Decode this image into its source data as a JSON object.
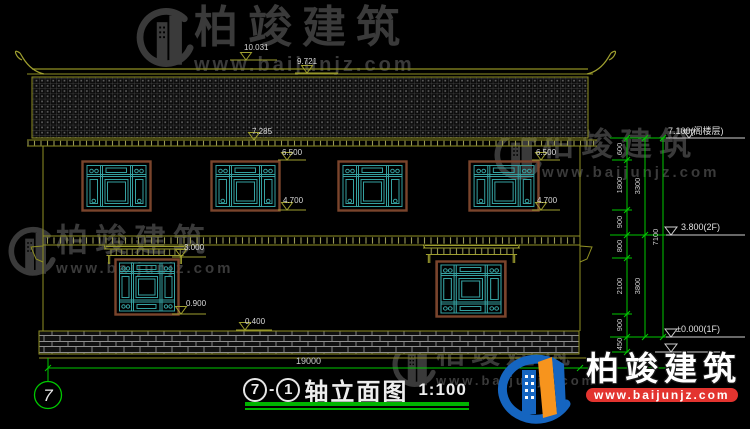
{
  "brand": {
    "name": "柏竣建筑",
    "site": "www.baijunjz.com"
  },
  "levels": {
    "ridge_top": "10.031",
    "ridge": "9.721",
    "eave": "7.285",
    "win2f_head_mid": "6.500",
    "win2f_sill_mid": "4.700",
    "win2f_head_right": "6.500",
    "win2f_sill_right": "4.700",
    "win1f_head": "3.000",
    "win1f_sill": "0.900",
    "plinth_top": "0.400",
    "attic": "7.100(阁楼层)",
    "floor2": "3.800(2F)",
    "floor1": "±0.000(1F)"
  },
  "dims": {
    "col1": [
      "600",
      "1800",
      "900",
      "800",
      "2100",
      "900",
      "450"
    ],
    "col2": [
      "3300",
      "3800"
    ],
    "col3": [
      "7100"
    ],
    "total_width": "19000"
  },
  "axis": {
    "bubble": "7"
  },
  "title": {
    "grid_from": "7",
    "sep": "-",
    "grid_to": "1",
    "name": "轴立面图",
    "scale": "1:100"
  }
}
